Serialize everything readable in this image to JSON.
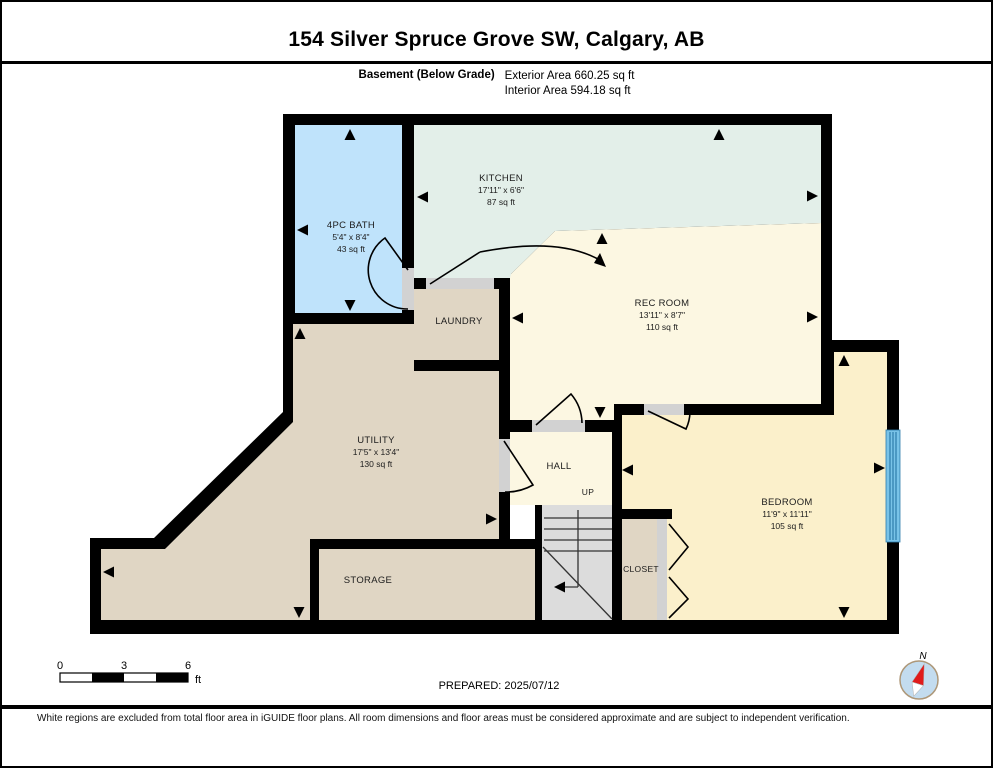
{
  "header": {
    "title": "154 Silver Spruce Grove SW, Calgary, AB",
    "floor_label": "Basement (Below Grade)",
    "exterior_area": "Exterior Area 660.25 sq ft",
    "interior_area": "Interior Area 594.18 sq ft"
  },
  "floorplan": {
    "rooms": [
      {
        "id": "bath",
        "name": "4PC BATH",
        "dims": "5'4\" x 8'4\"",
        "area": "43 sq ft"
      },
      {
        "id": "kitchen",
        "name": "KITCHEN",
        "dims": "17'11\" x 6'6\"",
        "area": "87 sq ft"
      },
      {
        "id": "rec-room",
        "name": "REC ROOM",
        "dims": "13'11\" x 8'7\"",
        "area": "110 sq ft"
      },
      {
        "id": "laundry",
        "name": "LAUNDRY"
      },
      {
        "id": "utility",
        "name": "UTILITY",
        "dims": "17'5\" x 13'4\"",
        "area": "130 sq ft"
      },
      {
        "id": "storage",
        "name": "STORAGE"
      },
      {
        "id": "hall",
        "name": "HALL"
      },
      {
        "id": "stairs",
        "name": "UP"
      },
      {
        "id": "closet",
        "name": "CLOSET"
      },
      {
        "id": "bedroom",
        "name": "BEDROOM",
        "dims": "11'9\" x 11'11\"",
        "area": "105 sq ft"
      }
    ],
    "colors": {
      "wall": "#000000",
      "bath": "#bfe3fb",
      "kitchen": "#e3efe9",
      "cream": "#fcf7e2",
      "bedroom": "#fbf0cb",
      "tan": "#e0d6c4",
      "stairs": "#dcdcdc",
      "door_gap": "#d2d2d2",
      "window": "#79c3e8"
    },
    "compass_label": "N"
  },
  "scalebar": {
    "labels": [
      "0",
      "3",
      "6"
    ],
    "unit": "ft"
  },
  "footer": {
    "prepared": "PREPARED: 2025/07/12",
    "disclaimer": "White regions are excluded from total floor area in iGUIDE floor plans. All room dimensions and floor areas must be considered approximate and are subject to independent verification."
  }
}
